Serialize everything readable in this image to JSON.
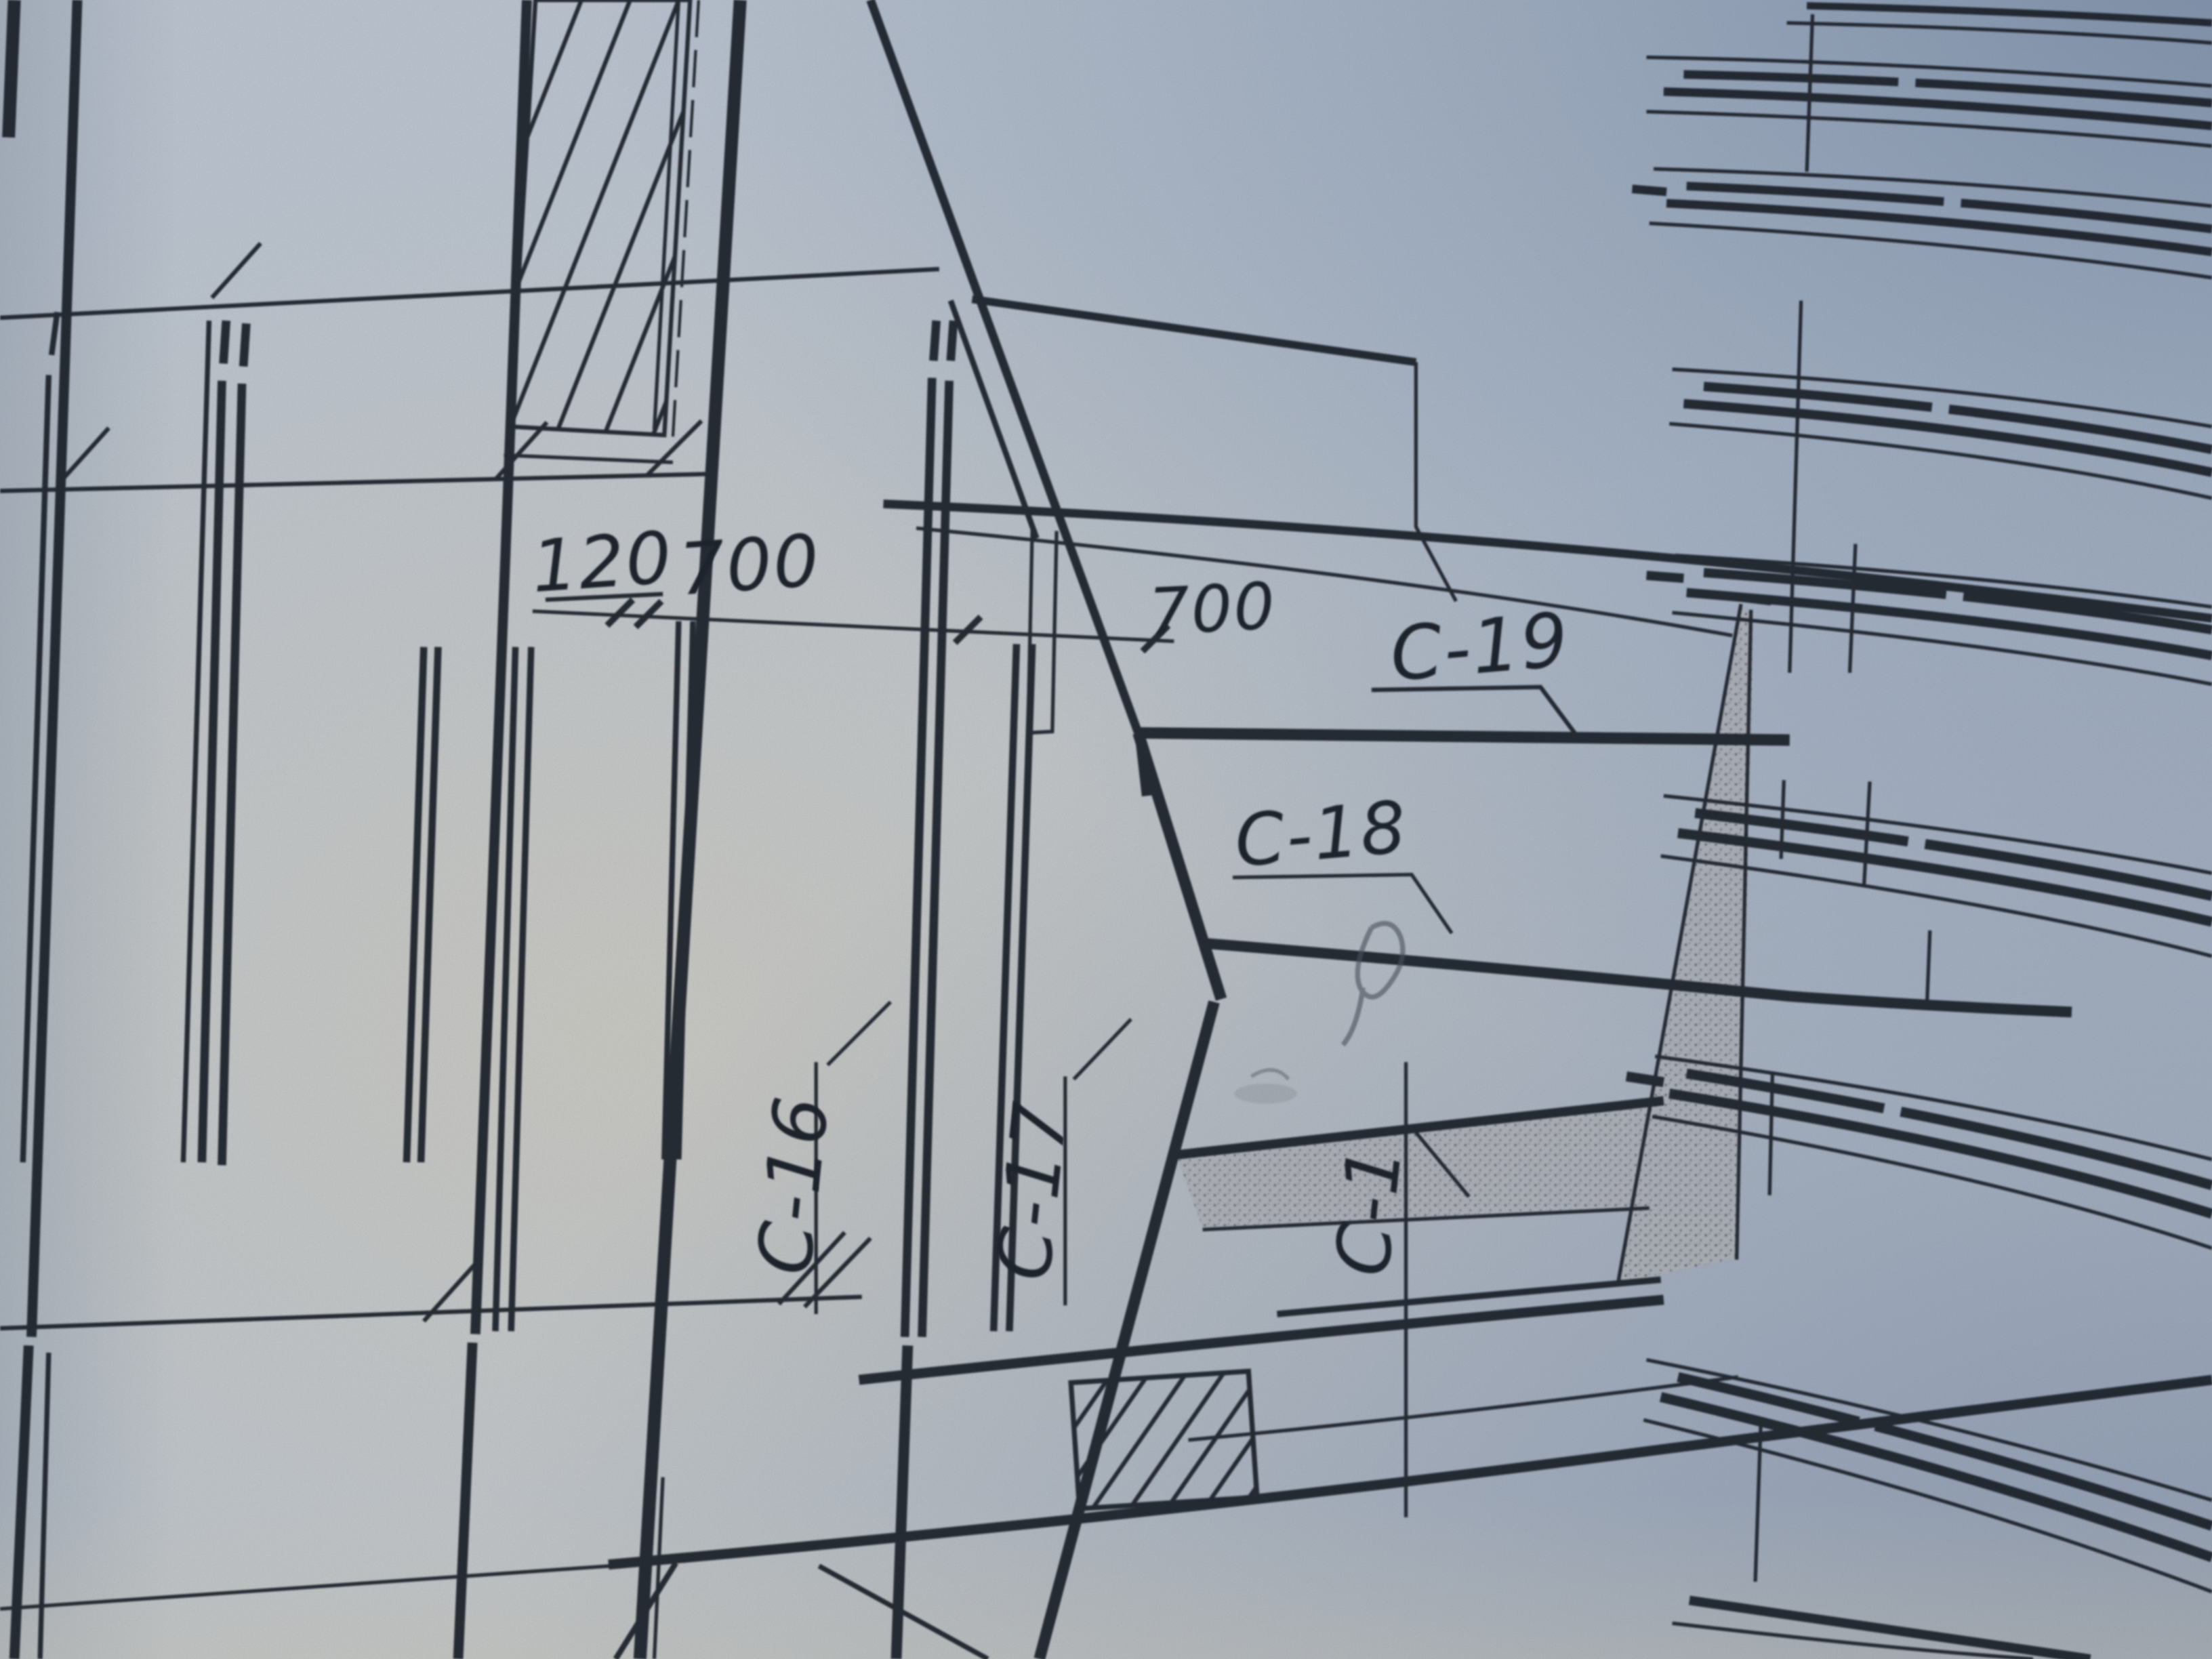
{
  "diagram": {
    "type": "technical-drawing-photo",
    "description": "Photograph of a structural reinforcement blueprint, tilted, blue-gray paper",
    "paper_color": "#b9c2cd",
    "ink_color": "#1d212b",
    "pencil_color": "#4a4f58",
    "stipple_color": "#9fa3ab",
    "labels": [
      {
        "id": "dim-120",
        "text": "120"
      },
      {
        "id": "dim-700-a",
        "text": "700"
      },
      {
        "id": "dim-700-b",
        "text": "700"
      },
      {
        "id": "label-c19",
        "text": "C-19"
      },
      {
        "id": "label-c18",
        "text": "C-18"
      },
      {
        "id": "label-c16",
        "text": "C-16"
      },
      {
        "id": "label-c17",
        "text": "C-17"
      },
      {
        "id": "label-c1",
        "text": "C-1"
      }
    ]
  }
}
